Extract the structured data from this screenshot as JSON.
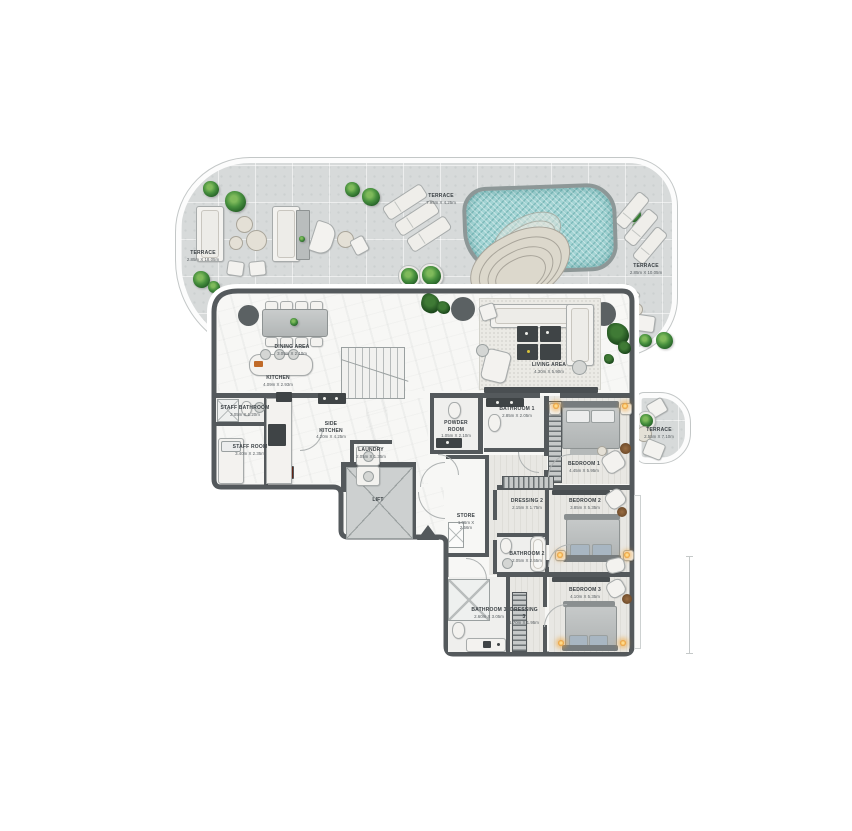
{
  "colors": {
    "paving": "#d7dada",
    "pool_water": "#a3d4d4",
    "wall": "#54595c",
    "interior_floor": "#f7f7f5",
    "plant_green": "#3f8f3c",
    "lamp_accent": "#e8952d"
  },
  "rooms": [
    {
      "id": "terrace-left",
      "name": "TERRACE",
      "dims": "2.85m X 18.05m"
    },
    {
      "id": "terrace-top",
      "name": "TERRACE",
      "dims": "7.95m X 4.25m"
    },
    {
      "id": "terrace-right",
      "name": "TERRACE",
      "dims": "2.85m X 10.05m"
    },
    {
      "id": "dining",
      "name": "DINING AREA",
      "dims": "3.09m X 2.10m"
    },
    {
      "id": "kitchen",
      "name": "KITCHEN",
      "dims": "4.09m X 2.93m"
    },
    {
      "id": "living",
      "name": "LIVING AREA",
      "dims": "4.30m X 5.90m"
    },
    {
      "id": "staff-bathroom",
      "name": "STAFF BATHROOM",
      "dims": "2.05m X 1.20m"
    },
    {
      "id": "staff-room",
      "name": "STAFF ROOM",
      "dims": "3.40m X 2.35m"
    },
    {
      "id": "side-kitchen",
      "name": "SIDE KITCHEN",
      "dims": "4.20m X 4.25m"
    },
    {
      "id": "laundry",
      "name": "LAUNDRY",
      "dims": "2.05m X 1.35m"
    },
    {
      "id": "powder-room",
      "name": "POWDER ROOM",
      "dims": "1.05m X 2.10m"
    },
    {
      "id": "bathroom-1",
      "name": "BATHROOM 1",
      "dims": "2.85m X 2.05m"
    },
    {
      "id": "bedroom-1",
      "name": "BEDROOM 1",
      "dims": "4.45m X 5.95m"
    },
    {
      "id": "lift",
      "name": "LIFT",
      "dims": ""
    },
    {
      "id": "store",
      "name": "STORE",
      "dims": "1.06m X 2.56m"
    },
    {
      "id": "dressing-2",
      "name": "DRESSING 2",
      "dims": "2.15m X 1.75m"
    },
    {
      "id": "bedroom-2",
      "name": "BEDROOM 2",
      "dims": "3.85m X 5.35m"
    },
    {
      "id": "bathroom-2",
      "name": "BATHROOM 2",
      "dims": "2.05m X 2.55m"
    },
    {
      "id": "bedroom-3",
      "name": "BEDROOM 3",
      "dims": "4.10m X 5.35m"
    },
    {
      "id": "bathroom-3",
      "name": "BATHROOM 3",
      "dims": "2.60m X 3.05m"
    },
    {
      "id": "dressing-3",
      "name": "DRESSING 3",
      "dims": "1.70m X 1.95m"
    },
    {
      "id": "terrace-small",
      "name": "TERRACE",
      "dims": "2.55m X 7.10m"
    }
  ]
}
